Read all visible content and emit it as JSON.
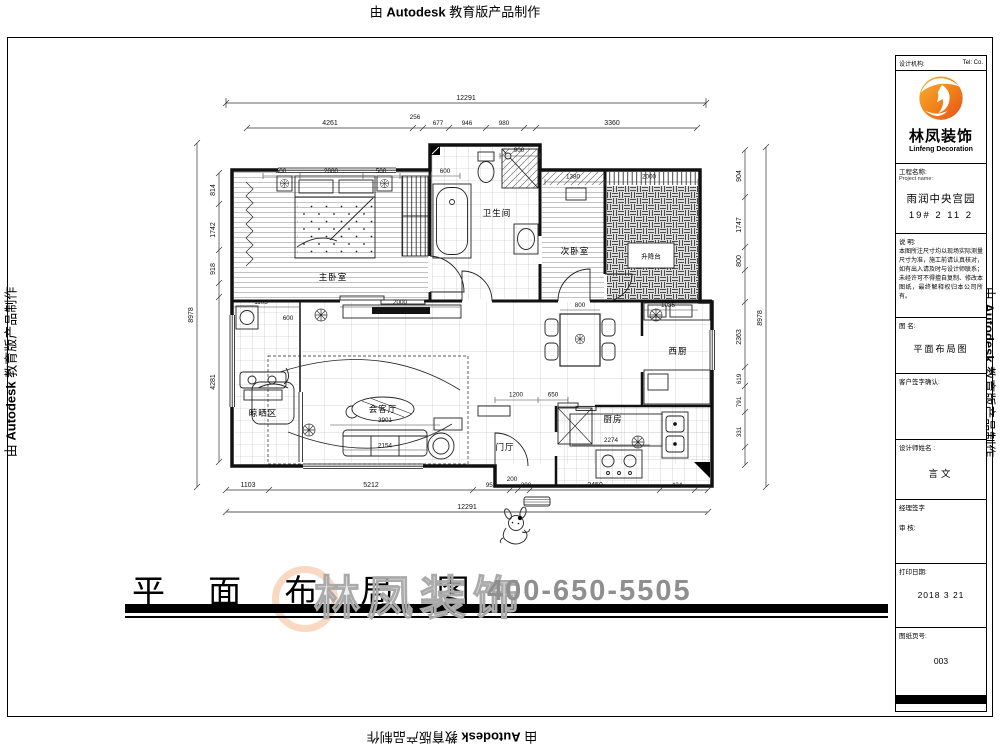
{
  "stamp": {
    "prefix": "由",
    "brand": "Autodesk",
    "suffix": "教育版产品制作"
  },
  "sheet": {
    "title": "平 面 布 局 图",
    "watermark_brand": "林凤装饰",
    "watermark_phone": "400-650-5505"
  },
  "title_block": {
    "header_left": "设计机构:",
    "header_right": "Tel:  Co.",
    "logo": {
      "brand": "林凤装饰",
      "subtitle": "Linfeng Decoration"
    },
    "project": {
      "label": "工程名称:",
      "sublabel": "Project name:",
      "name": "雨润中央宫园",
      "unit": "19# 2 11 2"
    },
    "notes": {
      "label": "说  明:",
      "text": "本图所注尺寸均以现场实际测量尺寸为准，施工前请认真核对，如有出入请及时与设计师联系；未经许可不得擅自复制、修改本图纸，最终解释权归本公司所有。"
    },
    "drawing_name": {
      "label": "图 名:",
      "value": "平面布局图"
    },
    "client": {
      "label": "客户签字确认:"
    },
    "designer": {
      "label": "设计师姓名 :",
      "value": "言文"
    },
    "manager": {
      "label": "经理签字",
      "label2": "审  核:"
    },
    "print_date": {
      "label": "打印日期:",
      "value": "2018 3 21"
    },
    "page_no": {
      "label": "图纸页号:",
      "value": "003"
    }
  },
  "plan": {
    "rooms": [
      "主卧室",
      "卫生间",
      "次卧室",
      "升降台",
      "晾晒区",
      "会客厅",
      "门厅",
      "厨房",
      "西厨"
    ],
    "dims": {
      "top_overall": "12291",
      "top": [
        "4261",
        "256",
        "677",
        "946",
        "980",
        "3360"
      ],
      "bottom": [
        "1103",
        "5212",
        "953",
        "200",
        "300",
        "2450",
        "424"
      ],
      "bottom_overall": "12291",
      "left_overall": "8978",
      "left": [
        "814",
        "1742",
        "918",
        "4281"
      ],
      "right": [
        "904",
        "1747",
        "800",
        "2363",
        "619",
        "791",
        "331"
      ],
      "right_overall": "8978",
      "inner": [
        "500",
        "2000",
        "500",
        "600",
        "900",
        "1380",
        "2000",
        "1103",
        "2000",
        "800",
        "1085",
        "3901",
        "2154",
        "1200",
        "650",
        "2274",
        "600"
      ]
    }
  }
}
